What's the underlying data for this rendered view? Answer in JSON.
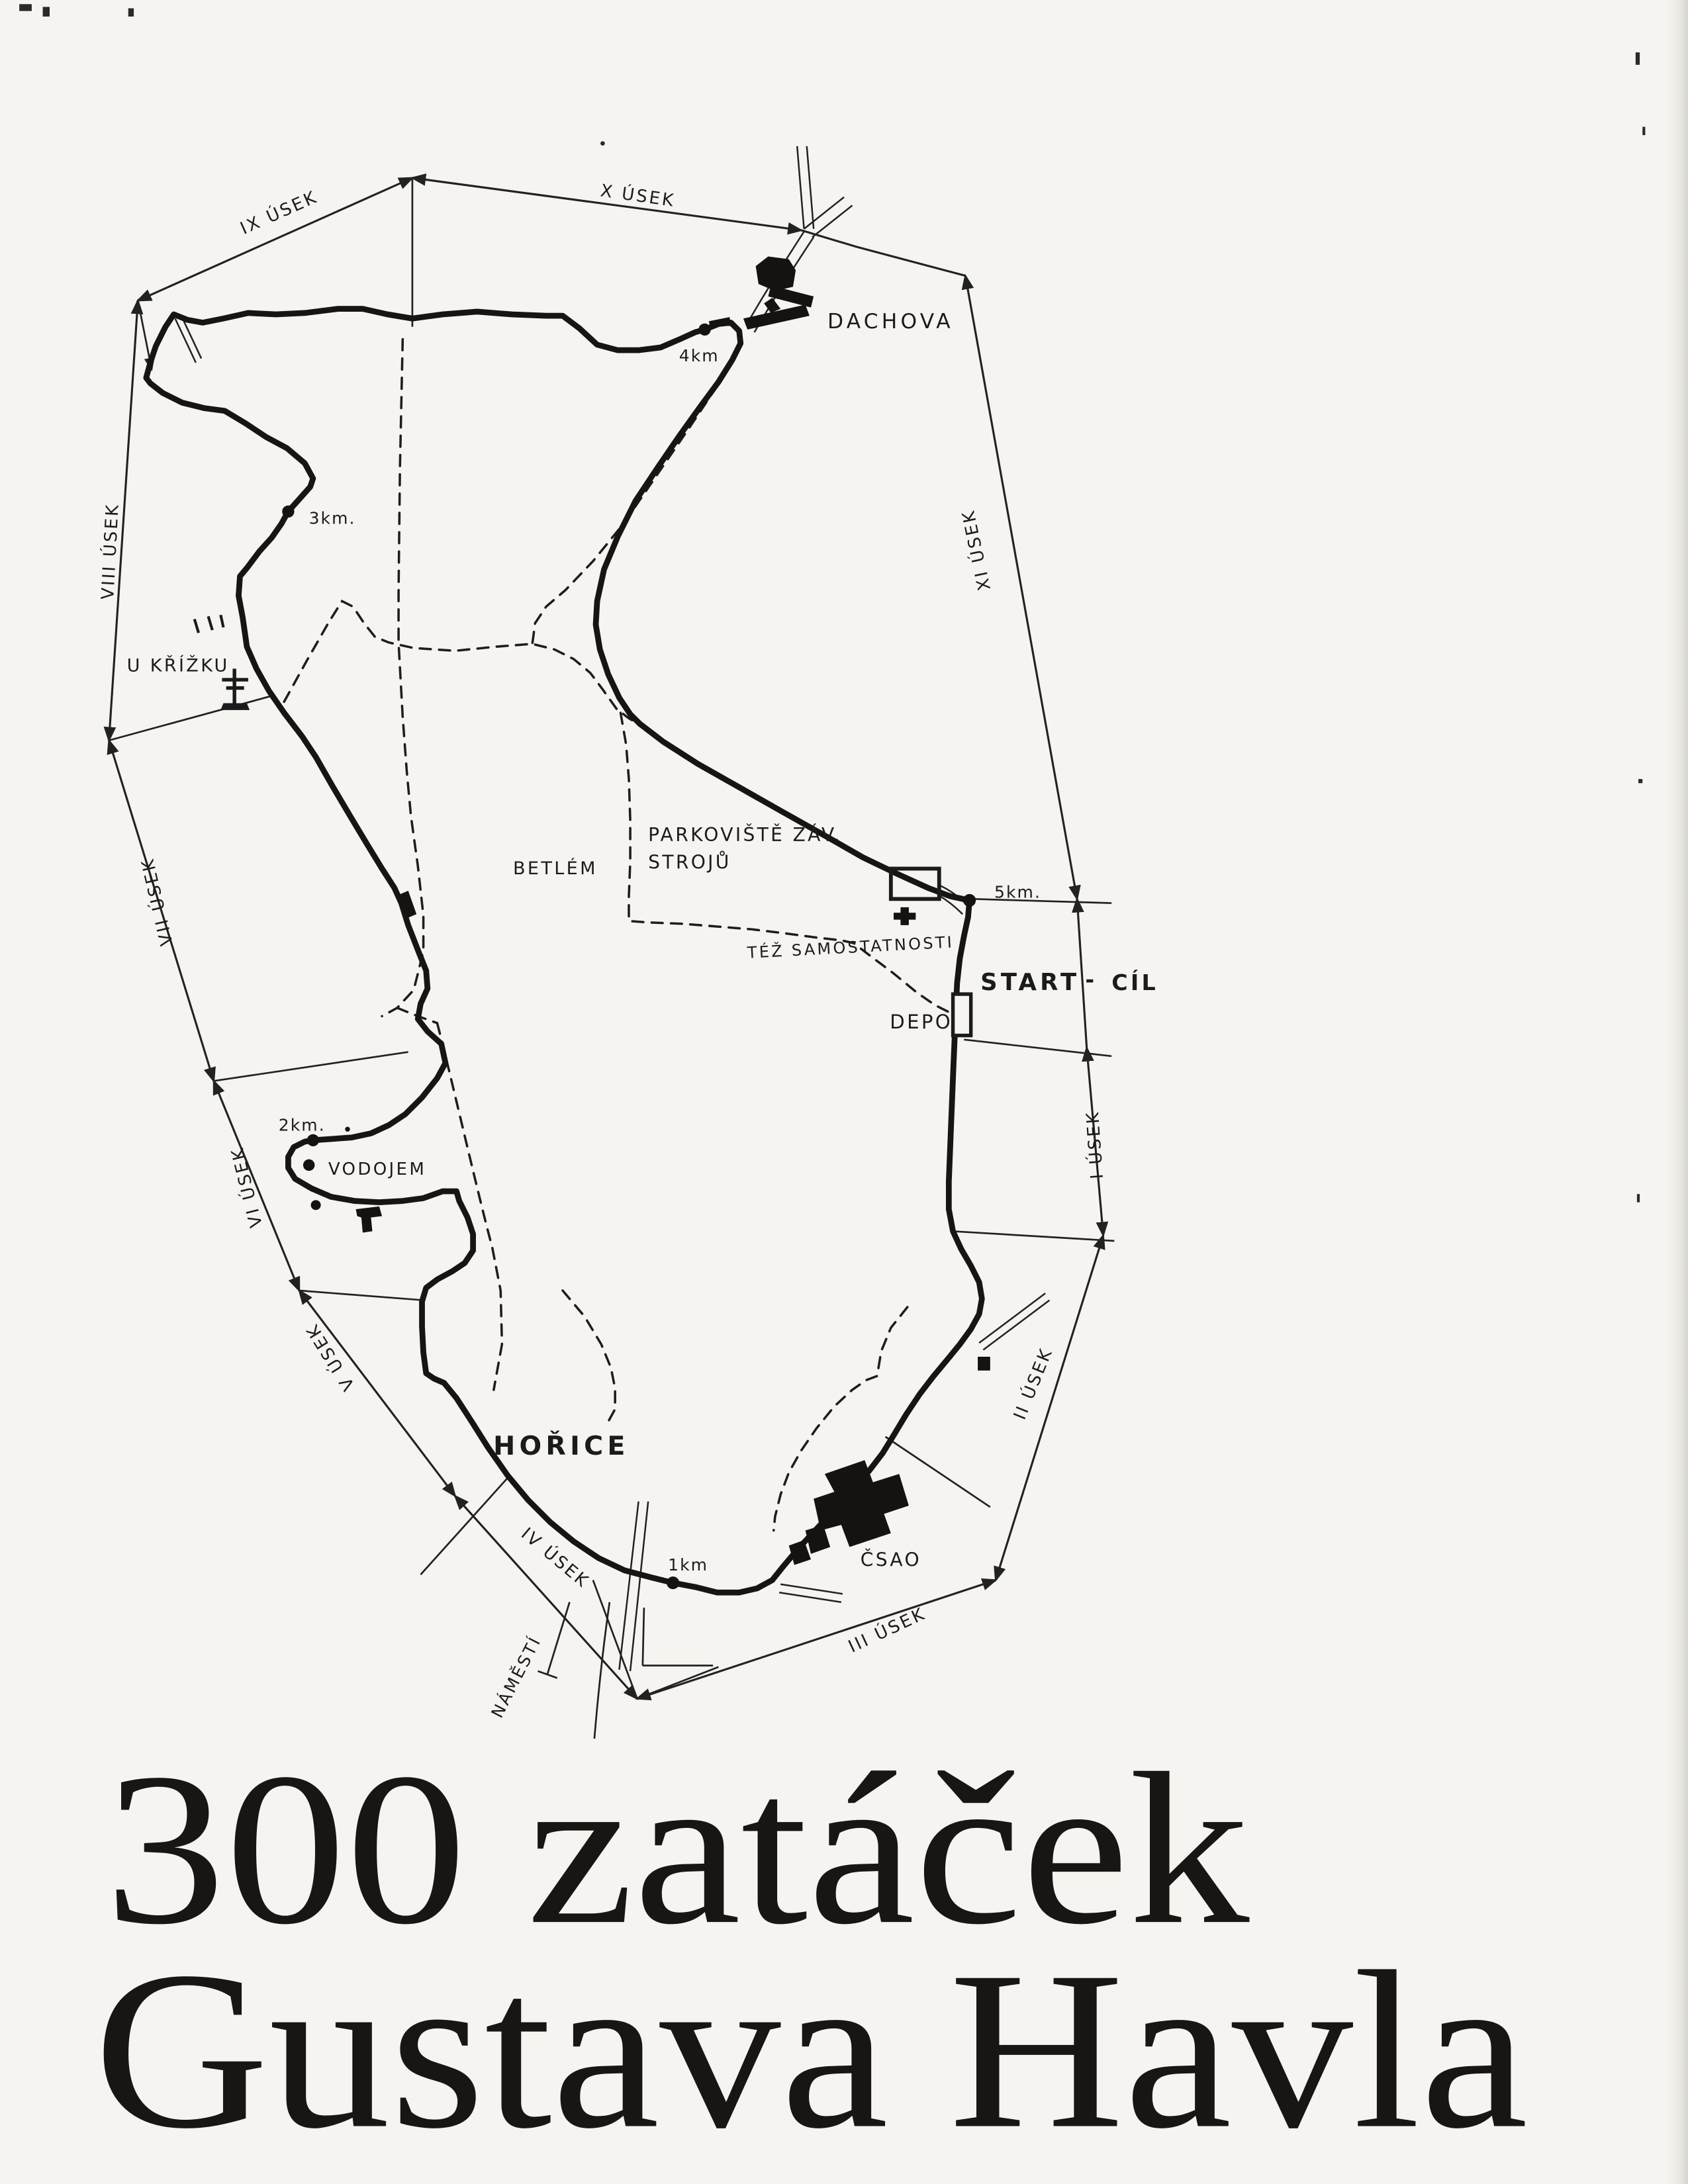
{
  "document": {
    "kind": "scanned circuit map poster",
    "title": {
      "line1": "300 zatáček",
      "line2": "Gustava Havla"
    }
  },
  "colors": {
    "ink": "#1b1b1b",
    "paper": "#f5f4f0"
  },
  "map": {
    "sections": [
      {
        "id": "I",
        "label": "I ÚSEK"
      },
      {
        "id": "II",
        "label": "II ÚSEK"
      },
      {
        "id": "III",
        "label": "III ÚSEK"
      },
      {
        "id": "IV",
        "label": "IV ÚSEK"
      },
      {
        "id": "V",
        "label": "V ÚSEK"
      },
      {
        "id": "VI",
        "label": "VI ÚSEK"
      },
      {
        "id": "VII",
        "label": "VII ÚSEK"
      },
      {
        "id": "VIII",
        "label": "VIII ÚSEK"
      },
      {
        "id": "IX",
        "label": "IX ÚSEK"
      },
      {
        "id": "X",
        "label": "X ÚSEK"
      },
      {
        "id": "XI",
        "label": "XI ÚSEK"
      }
    ],
    "km_markers": [
      {
        "label": "1km"
      },
      {
        "label": "2km."
      },
      {
        "label": "3km."
      },
      {
        "label": "4km"
      },
      {
        "label": "5km."
      }
    ],
    "places": {
      "dachova": "DACHOVA",
      "u_krizku": "U KŘÍŽKU",
      "betlem": "BETLÉM",
      "parkoviste_line1": "PARKOVIŠTĚ ZÁV.",
      "parkoviste_line2": "STROJŮ",
      "tez_samostatnosti": "TÉŽ SAMOSTATNOSTI",
      "start": "START",
      "start_cil_separator": "-",
      "cil": "CÍL",
      "depo": "DEPO",
      "vodojem": "VODOJEM",
      "horice": "HOŘICE",
      "csao": "ČSAO",
      "namesti": "NÁMĚSTÍ"
    }
  }
}
